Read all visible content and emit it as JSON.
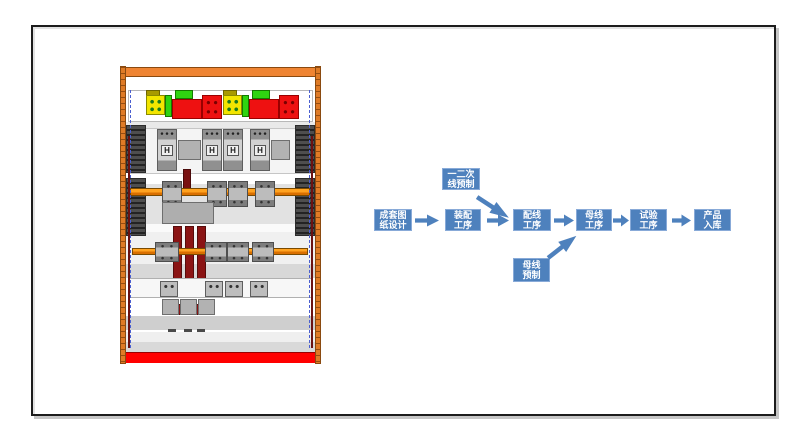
{
  "flowchart": {
    "accent_color": "#4e81bd",
    "text_color": "#ffffff",
    "steps": [
      {
        "label": "成套图\n纸设计"
      },
      {
        "label": "装配\n工序"
      },
      {
        "label": "配线\n工序"
      },
      {
        "label": "母线\n工序"
      },
      {
        "label": "试验\n工序"
      },
      {
        "label": "产品\n入库"
      }
    ],
    "branches": {
      "top": {
        "label": "一二次\n线预制"
      },
      "bottom": {
        "label": "母线\n预制"
      }
    }
  },
  "cabinet": {
    "breaker_symbol": "H",
    "colors": {
      "frame_orange": "#df7b26",
      "busbar_orange": "#ff8c00",
      "bottom_strip_red": "#ff0000",
      "component_red": "#ee1111",
      "vertical_bus_dark_red": "#8b1414",
      "terminal_yellow": "#f2e500",
      "terminal_green": "#2fd411"
    }
  }
}
